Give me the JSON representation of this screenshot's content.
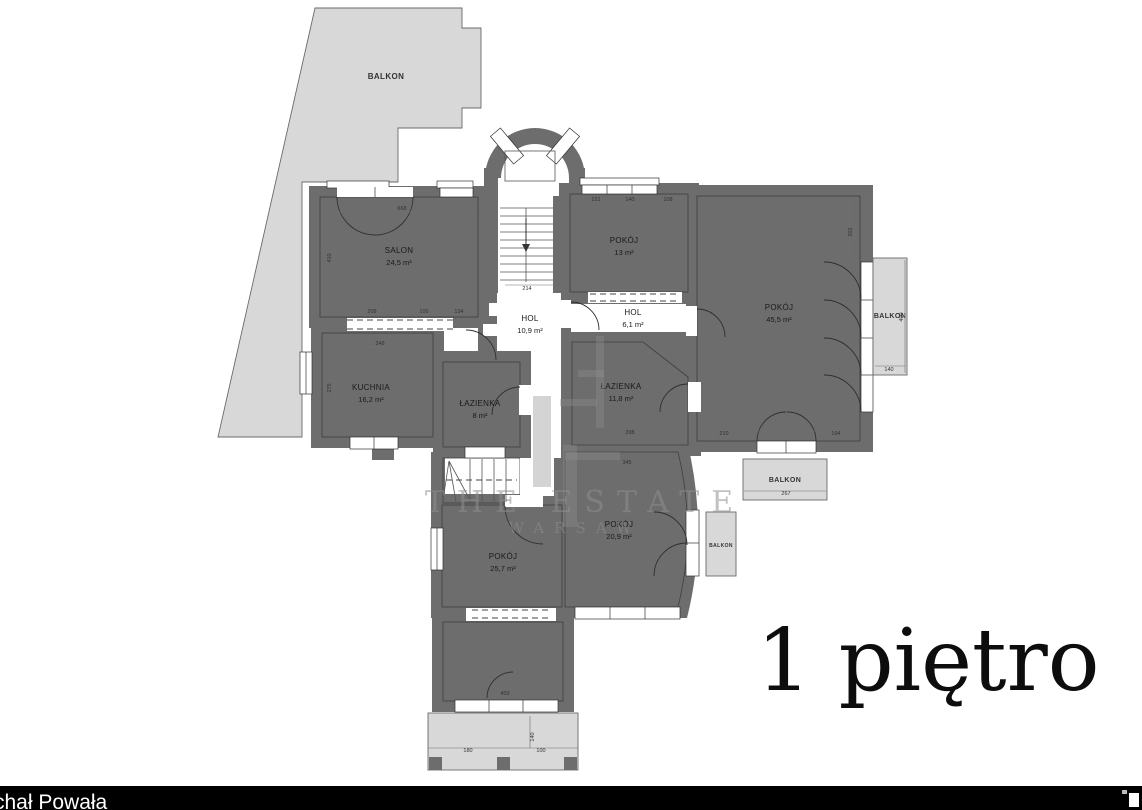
{
  "floor": {
    "title": "1 piętro"
  },
  "watermark": {
    "line1": "THE ESTATE",
    "line2": "WARSAW"
  },
  "footer": {
    "credit": "chał Powała"
  },
  "palette": {
    "wall": "#6d6d6d",
    "balcony": "#d8d8d8",
    "yellow_room": "#f8f5a8",
    "peach_room": "#f3dec1",
    "blue_room": "#a7d2f1",
    "purple_room": "#cfc8ec",
    "white_room": "#ffffff",
    "footer_bg": "#000000",
    "footer_text": "#ffffff",
    "watermark_gray": "#8f8f8f"
  },
  "rooms": [
    {
      "name": "SALON",
      "area": "24,5 m²",
      "fill": "#f8f5a8"
    },
    {
      "name": "KUCHNIA",
      "area": "16,2 m²",
      "fill": "#f3dec1"
    },
    {
      "name": "ŁAZIENKA",
      "area": "8 m²",
      "fill": "#a7d2f1"
    },
    {
      "name": "HOL",
      "area": "10,9 m²",
      "fill": "#ffffff"
    },
    {
      "name": "POKÓJ",
      "area": "13 m²",
      "fill": "#cfc8ec"
    },
    {
      "name": "HOL",
      "area": "6,1 m²",
      "fill": "#ffffff"
    },
    {
      "name": "POKÓJ",
      "area": "45,5 m²",
      "fill": "#cfc8ec"
    },
    {
      "name": "ŁAZIENKA",
      "area": "11,8 m²",
      "fill": "#a7d2f1"
    },
    {
      "name": "POKÓJ",
      "area": "20,9 m²",
      "fill": "#cfc8ec"
    },
    {
      "name": "POKÓJ",
      "area": "25,7 m²",
      "fill": "#f8f5a8"
    },
    {
      "name": "",
      "area": "",
      "fill": "#f8f5a8"
    }
  ],
  "balconies": {
    "top_left": "BALKON",
    "right": "BALKON",
    "middle": "BALKON",
    "small": "BALKON"
  },
  "dimensions": [
    {
      "v": "668",
      "x": 402,
      "y": 210
    },
    {
      "v": "410",
      "x": 331,
      "y": 258,
      "r": -90
    },
    {
      "v": "208",
      "x": 372,
      "y": 313
    },
    {
      "v": "100",
      "x": 424,
      "y": 313
    },
    {
      "v": "134",
      "x": 459,
      "y": 313
    },
    {
      "v": "348",
      "x": 380,
      "y": 345
    },
    {
      "v": "275",
      "x": 331,
      "y": 388,
      "r": -90
    },
    {
      "v": "121",
      "x": 596,
      "y": 201
    },
    {
      "v": "140",
      "x": 630,
      "y": 201
    },
    {
      "v": "108",
      "x": 668,
      "y": 201
    },
    {
      "v": "214",
      "x": 527,
      "y": 290
    },
    {
      "v": "201",
      "x": 852,
      "y": 232,
      "r": -90
    },
    {
      "v": "398",
      "x": 630,
      "y": 434
    },
    {
      "v": "345",
      "x": 627,
      "y": 464
    },
    {
      "v": "210",
      "x": 724,
      "y": 435
    },
    {
      "v": "194",
      "x": 836,
      "y": 435
    },
    {
      "v": "267",
      "x": 786,
      "y": 495
    },
    {
      "v": "140",
      "x": 889,
      "y": 371
    },
    {
      "v": "400",
      "x": 903,
      "y": 317,
      "r": -90
    },
    {
      "v": "403",
      "x": 505,
      "y": 695
    },
    {
      "v": "180",
      "x": 468,
      "y": 752
    },
    {
      "v": "100",
      "x": 541,
      "y": 752
    },
    {
      "v": "140",
      "x": 534,
      "y": 737,
      "r": -90
    }
  ]
}
